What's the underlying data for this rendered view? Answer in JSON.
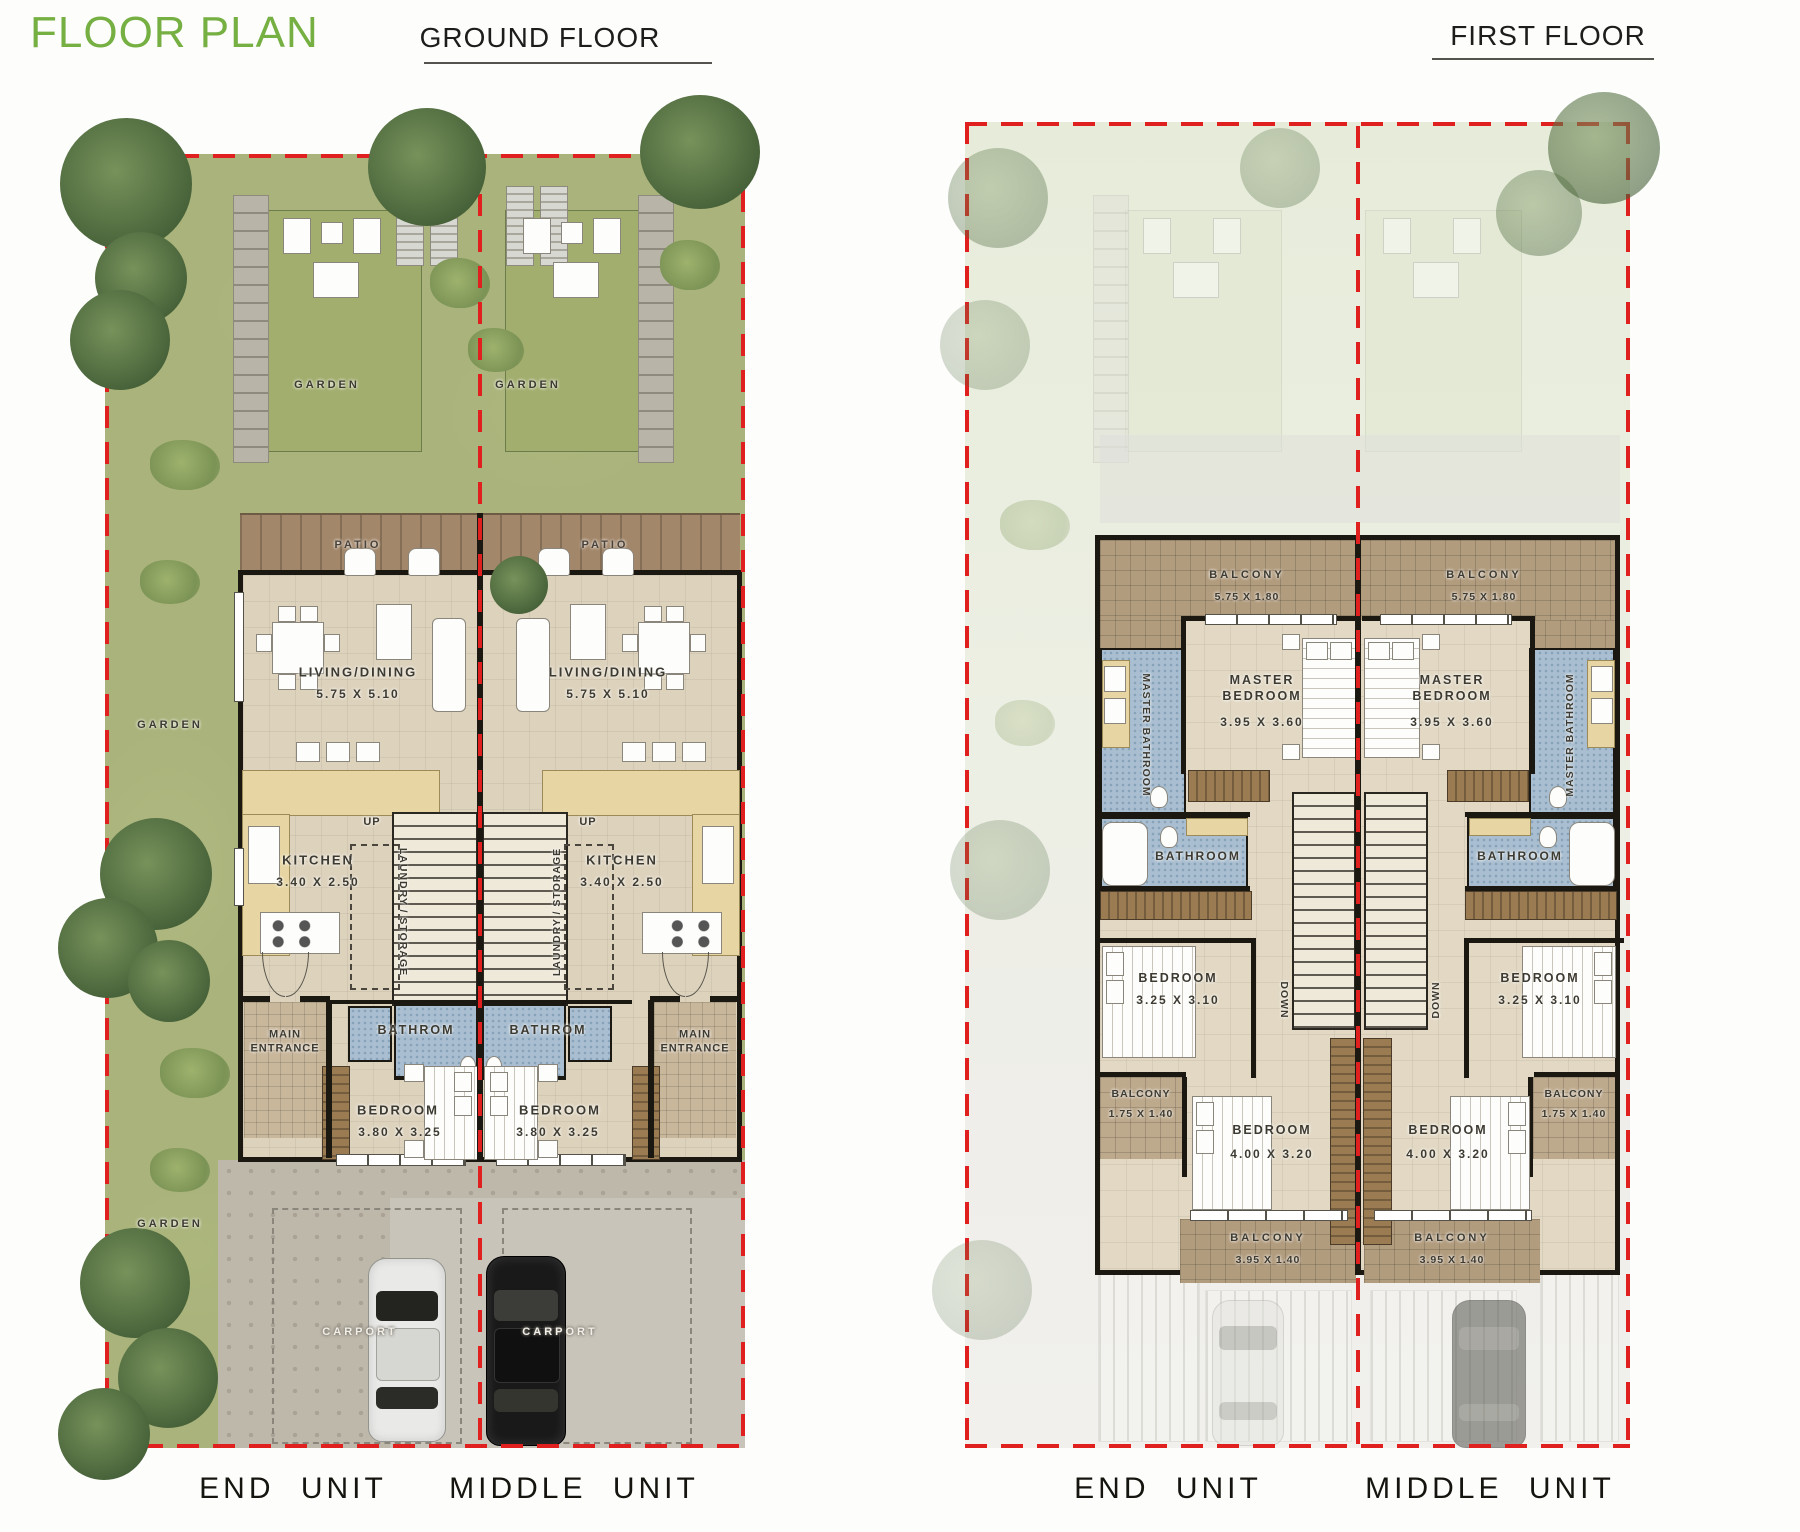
{
  "header": {
    "title": "FLOOR PLAN",
    "ground_floor": "GROUND FLOOR",
    "first_floor": "FIRST FLOOR"
  },
  "colors": {
    "accent_green": "#76b043",
    "plot_red": "#e01f1f",
    "wall_black": "#1b1711"
  },
  "ground_floor": {
    "gardens": {
      "top_left": "GARDEN",
      "top_right": "GARDEN",
      "side": "GARDEN",
      "side_lower": "GARDEN"
    },
    "units": [
      {
        "patio": "PATIO",
        "living": "LIVING/DINING",
        "living_dim": "5.75 X 5.10",
        "kitchen": "KITCHEN",
        "kitchen_dim": "3.40 X 2.50",
        "up": "UP",
        "laundry": "LAUNDRY / STORAGE",
        "bath": "BATHROM",
        "entrance": "MAIN ENTRANCE",
        "bedroom": "BEDROOM",
        "bedroom_dim": "3.80 X 3.25",
        "carport": "CARPORT",
        "label": "END UNIT"
      },
      {
        "patio": "PATIO",
        "living": "LIVING/DINING",
        "living_dim": "5.75 X 5.10",
        "kitchen": "KITCHEN",
        "kitchen_dim": "3.40 X 2.50",
        "up": "UP",
        "laundry": "LAUNDRY / STORAGE",
        "bath": "BATHROM",
        "entrance": "MAIN ENTRANCE",
        "bedroom": "BEDROOM",
        "bedroom_dim": "3.80 X 3.25",
        "carport": "CARPORT",
        "label": "MIDDLE UNIT"
      }
    ]
  },
  "first_floor": {
    "units": [
      {
        "balcony": "BALCONY",
        "balcony_dim": "5.75 X 1.80",
        "master_bedroom": "MASTER BEDROOM",
        "master_bedroom_dim": "3.95 X 3.60",
        "master_bathroom": "MASTER BATHROOM",
        "bathroom": "BATHROOM",
        "bedroom1": "BEDROOM",
        "bedroom1_dim": "3.25 X 3.10",
        "down": "DOWN",
        "side_balcony": "BALCONY",
        "side_balcony_dim": "1.75 X 1.40",
        "bedroom2": "BEDROOM",
        "bedroom2_dim": "4.00 X 3.20",
        "bottom_balcony": "BALCONY",
        "bottom_balcony_dim": "3.95 X 1.40",
        "label": "END UNIT"
      },
      {
        "balcony": "BALCONY",
        "balcony_dim": "5.75 X 1.80",
        "master_bedroom": "MASTER BEDROOM",
        "master_bedroom_dim": "3.95 X 3.60",
        "master_bathroom": "MASTER BATHROOM",
        "bathroom": "BATHROOM",
        "bedroom1": "BEDROOM",
        "bedroom1_dim": "3.25 X 3.10",
        "down": "DOWN",
        "side_balcony": "BALCONY",
        "side_balcony_dim": "1.75 X 1.40",
        "bedroom2": "BEDROOM",
        "bedroom2_dim": "4.00 X 3.20",
        "bottom_balcony": "BALCONY",
        "bottom_balcony_dim": "3.95 X 1.40",
        "label": "MIDDLE UNIT"
      }
    ]
  }
}
